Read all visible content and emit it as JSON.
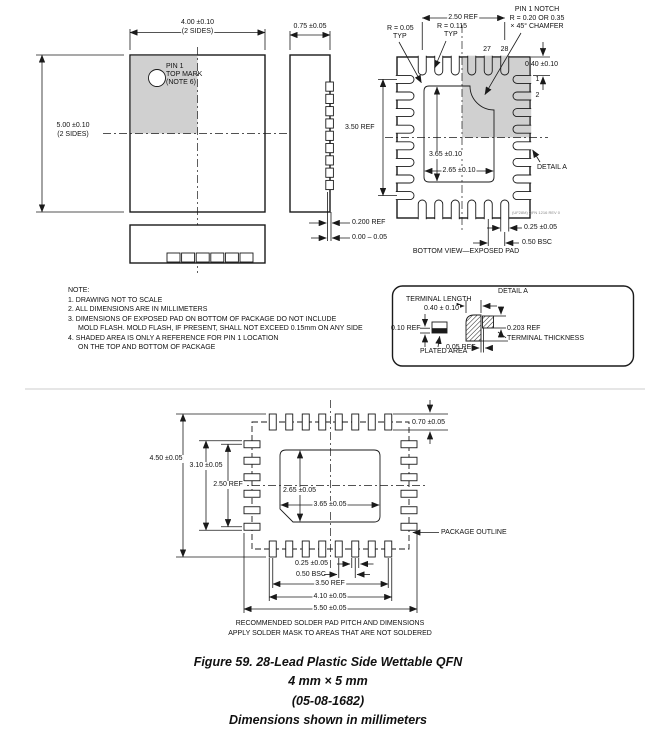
{
  "figure": {
    "title": "Figure 59. 28-Lead Plastic Side Wettable QFN",
    "size": "4 mm × 5 mm",
    "drawing_number": "(05-08-1682)",
    "units": "Dimensions shown in millimeters"
  },
  "notes": {
    "heading": "NOTE:",
    "lines": [
      "1. DRAWING NOT TO SCALE",
      "2. ALL DIMENSIONS ARE IN MILLIMETERS",
      "3. DIMENSIONS OF EXPOSED PAD ON BOTTOM OF PACKAGE DO NOT INCLUDE",
      "MOLD FLASH. MOLD FLASH, IF PRESENT, SHALL NOT EXCEED 0.15mm ON ANY SIDE",
      "4. SHADED AREA IS ONLY A REFERENCE FOR PIN 1 LOCATION",
      "ON THE TOP AND BOTTOM OF PACKAGE"
    ]
  },
  "top_view": {
    "width_dim": "4.00 ±0.10",
    "width_note": "(2 SIDES)",
    "height_dim": "5.00 ±0.10",
    "height_note": "(2 SIDES)",
    "pin1_line1": "PIN 1",
    "pin1_line2": "TOP MARK",
    "pin1_line3": "(NOTE 6)"
  },
  "side_view": {
    "thickness_dim": "0.75 ±0.05",
    "standoff_ref": "0.200 REF",
    "standoff_range": "0.00 – 0.05"
  },
  "bottom_view": {
    "top_span_ref": "2.50 REF",
    "side_span_ref": "3.50 REF",
    "corner_radius": "R = 0.05",
    "corner_radius_typ": "TYP",
    "lead_radius": "R = 0.115",
    "lead_radius_typ": "TYP",
    "notch_line1": "PIN 1 NOTCH",
    "notch_line2": "R = 0.20 OR 0.35",
    "notch_line3": "× 45° CHAMFER",
    "pin27": "27",
    "pin28": "28",
    "pin1": "1",
    "pin2": "2",
    "lead_length_dim": "0.40 ±0.10",
    "pad_height_dim": "3.65 ±0.10",
    "pad_width_dim": "2.65 ±0.10",
    "detail_ref": "DETAIL A",
    "lead_width_dim": "0.25 ±0.05",
    "pitch_dim": "0.50 BSC",
    "caption": "BOTTOM VIEW—EXPOSED PAD",
    "rev_note": "(UF28M) QFN 1216 REV 0"
  },
  "detail_a": {
    "title": "DETAIL A",
    "terminal_length_label": "TERMINAL LENGTH",
    "terminal_length_dim": "0.40 ± 0.10",
    "plating_ref": "0.10 REF",
    "plated_area_label": "PLATED AREA",
    "gap_ref": "0.05 REF",
    "thickness_ref": "0.203 REF",
    "thickness_label": "TERMINAL THICKNESS"
  },
  "solder_pad": {
    "outer_height": "4.50 ±0.05",
    "inner_height": "3.10 ±0.05",
    "row_span_v": "2.50 REF",
    "pad_height": "2.65 ±0.05",
    "pad_width": "3.65 ±0.05",
    "pad_length": "0.70 ±0.05",
    "outline_label": "PACKAGE OUTLINE",
    "pad_w": "0.25 ±0.05",
    "pitch": "0.50 BSC",
    "row_span_h": "3.50 REF",
    "inner_width": "4.10 ±0.05",
    "outer_width": "5.50 ±0.05",
    "caption_line1": "RECOMMENDED SOLDER PAD PITCH AND DIMENSIONS",
    "caption_line2": "APPLY SOLDER MASK TO AREAS THAT ARE NOT SOLDERED"
  }
}
